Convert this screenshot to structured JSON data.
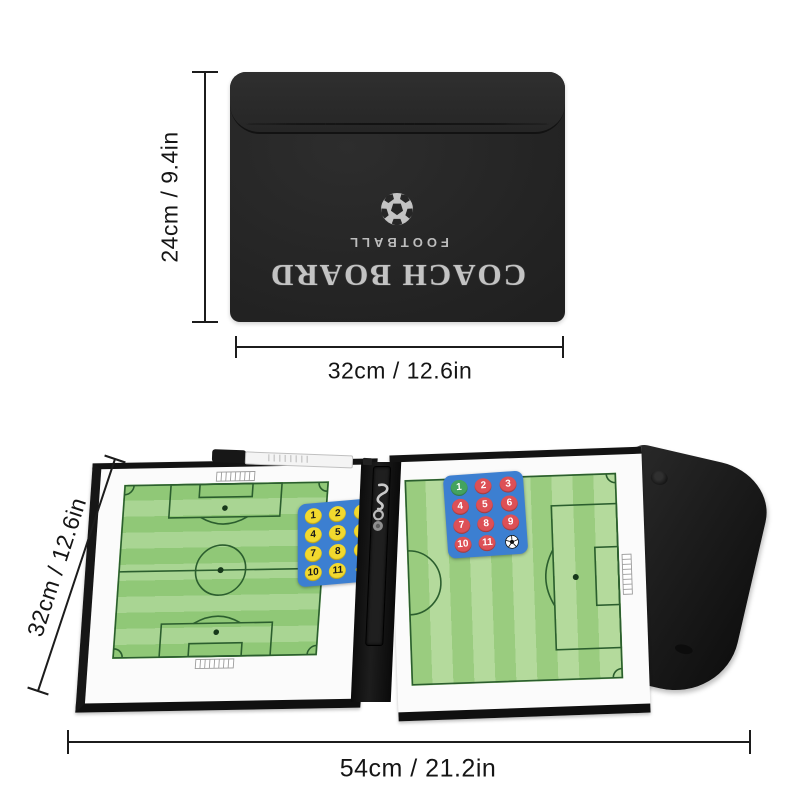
{
  "case": {
    "brand_title": "COACH BOARD",
    "brand_subtitle": "FOOTBALL",
    "ball_icon": "soccer-ball-icon",
    "height_label": "24cm / 9.4in",
    "width_label": "32cm / 12.6in"
  },
  "open_board": {
    "height_label": "32cm / 12.6in",
    "width_label": "54cm / 21.2in",
    "left_pad": {
      "numbers": [
        "1",
        "2",
        "3",
        "4",
        "5",
        "6",
        "7",
        "8",
        "9",
        "10",
        "11"
      ],
      "extra_icon": "whistle-icon"
    },
    "right_pad": {
      "numbers": [
        "1",
        "2",
        "3",
        "4",
        "5",
        "6",
        "7",
        "8",
        "9",
        "10",
        "11"
      ],
      "extra_icon": "soccer-ball-icon"
    }
  },
  "colors": {
    "case_black": "#242424",
    "print_silver": "#c3c3c3",
    "dim_line": "#1c1c1c",
    "pitch_light_green": "#a9d593",
    "pitch_dark_green": "#90c877",
    "pitch_line_green": "#2b5e2e",
    "pad_blue": "#3c7fd1",
    "pad_yellow": "#f2d92e",
    "pad_red": "#dd5056",
    "pad_green": "#43a35e"
  }
}
